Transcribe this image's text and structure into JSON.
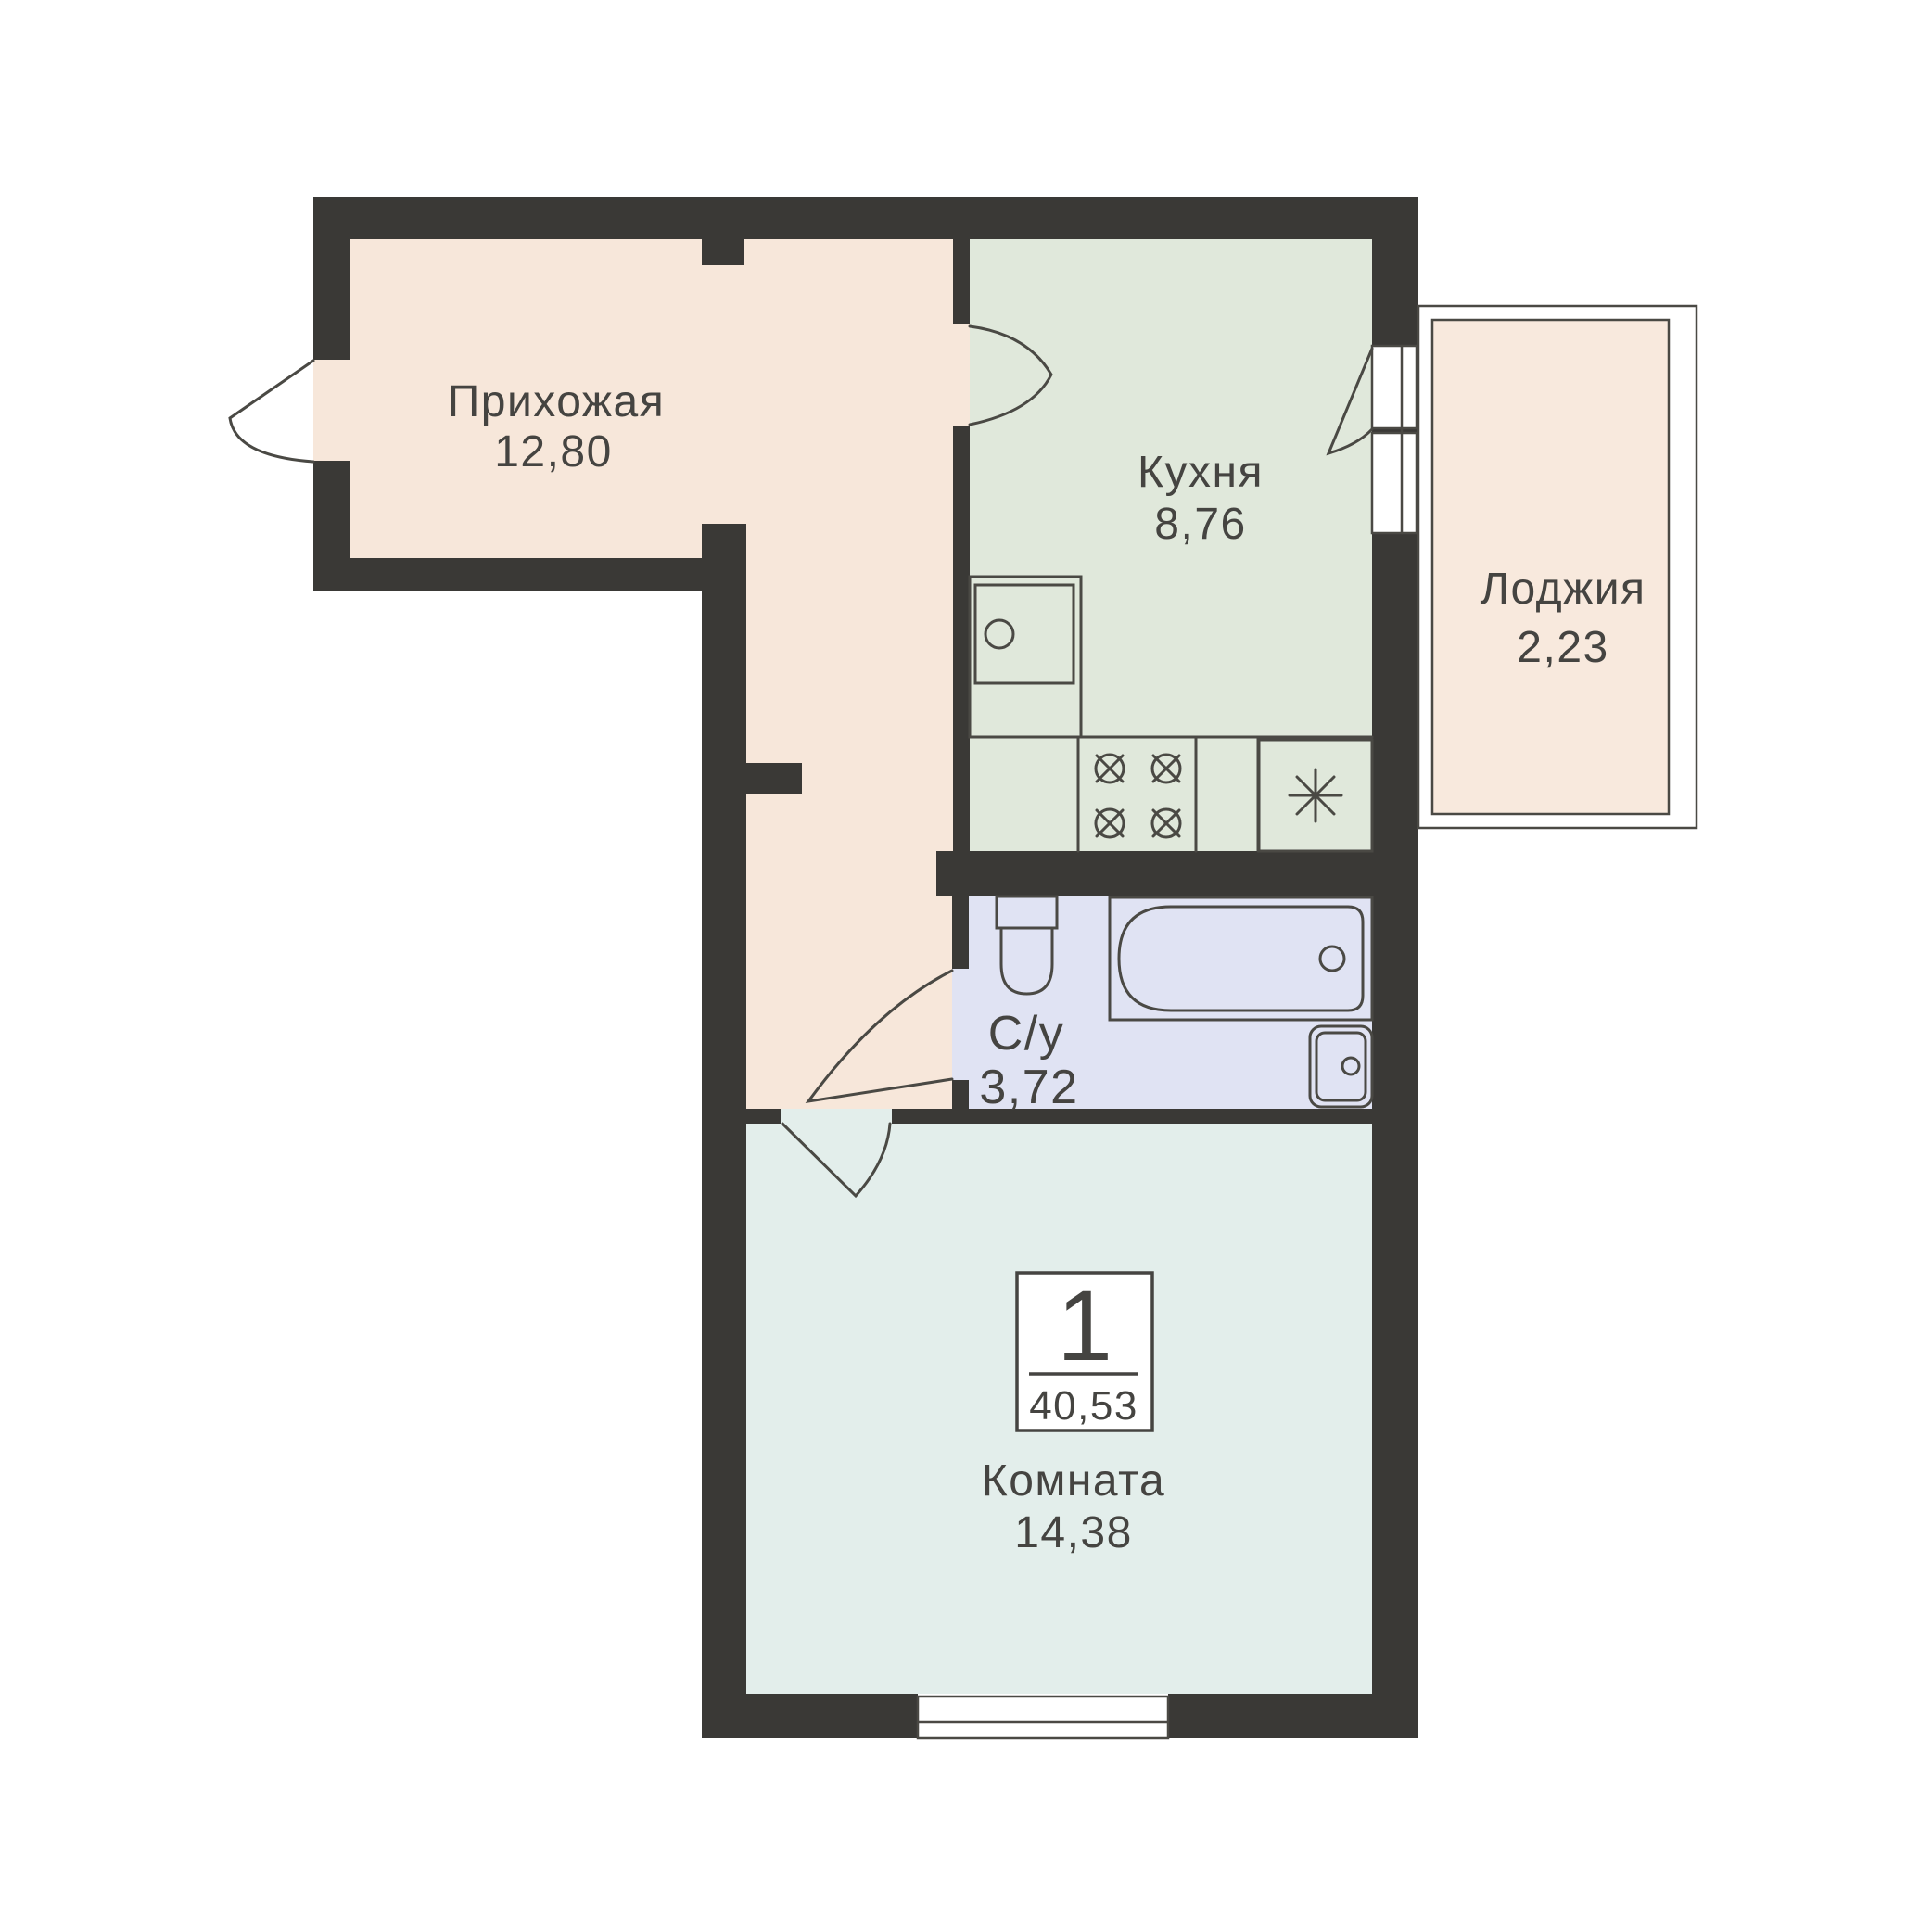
{
  "rooms": {
    "hallway": {
      "label": "Прихожая",
      "area": "12,80"
    },
    "kitchen": {
      "label": "Кухня",
      "area": "8,76"
    },
    "loggia": {
      "label": "Лоджия",
      "area": "2,23"
    },
    "bathroom": {
      "label": "С/у",
      "area": "3,72"
    },
    "room": {
      "label": "Комната",
      "area": "14,38"
    }
  },
  "badge": {
    "room_count": "1",
    "total_area": "40,53"
  },
  "colors": {
    "wall": "#3a3936",
    "hallway": "#f7e7da",
    "kitchen": "#e0e8db",
    "bathroom": "#e0e3f3",
    "room": "#e3eeeb",
    "loggia": "#f8e9dd",
    "outline": "#4a4944",
    "text": "#454441",
    "background": "#ffffff"
  }
}
